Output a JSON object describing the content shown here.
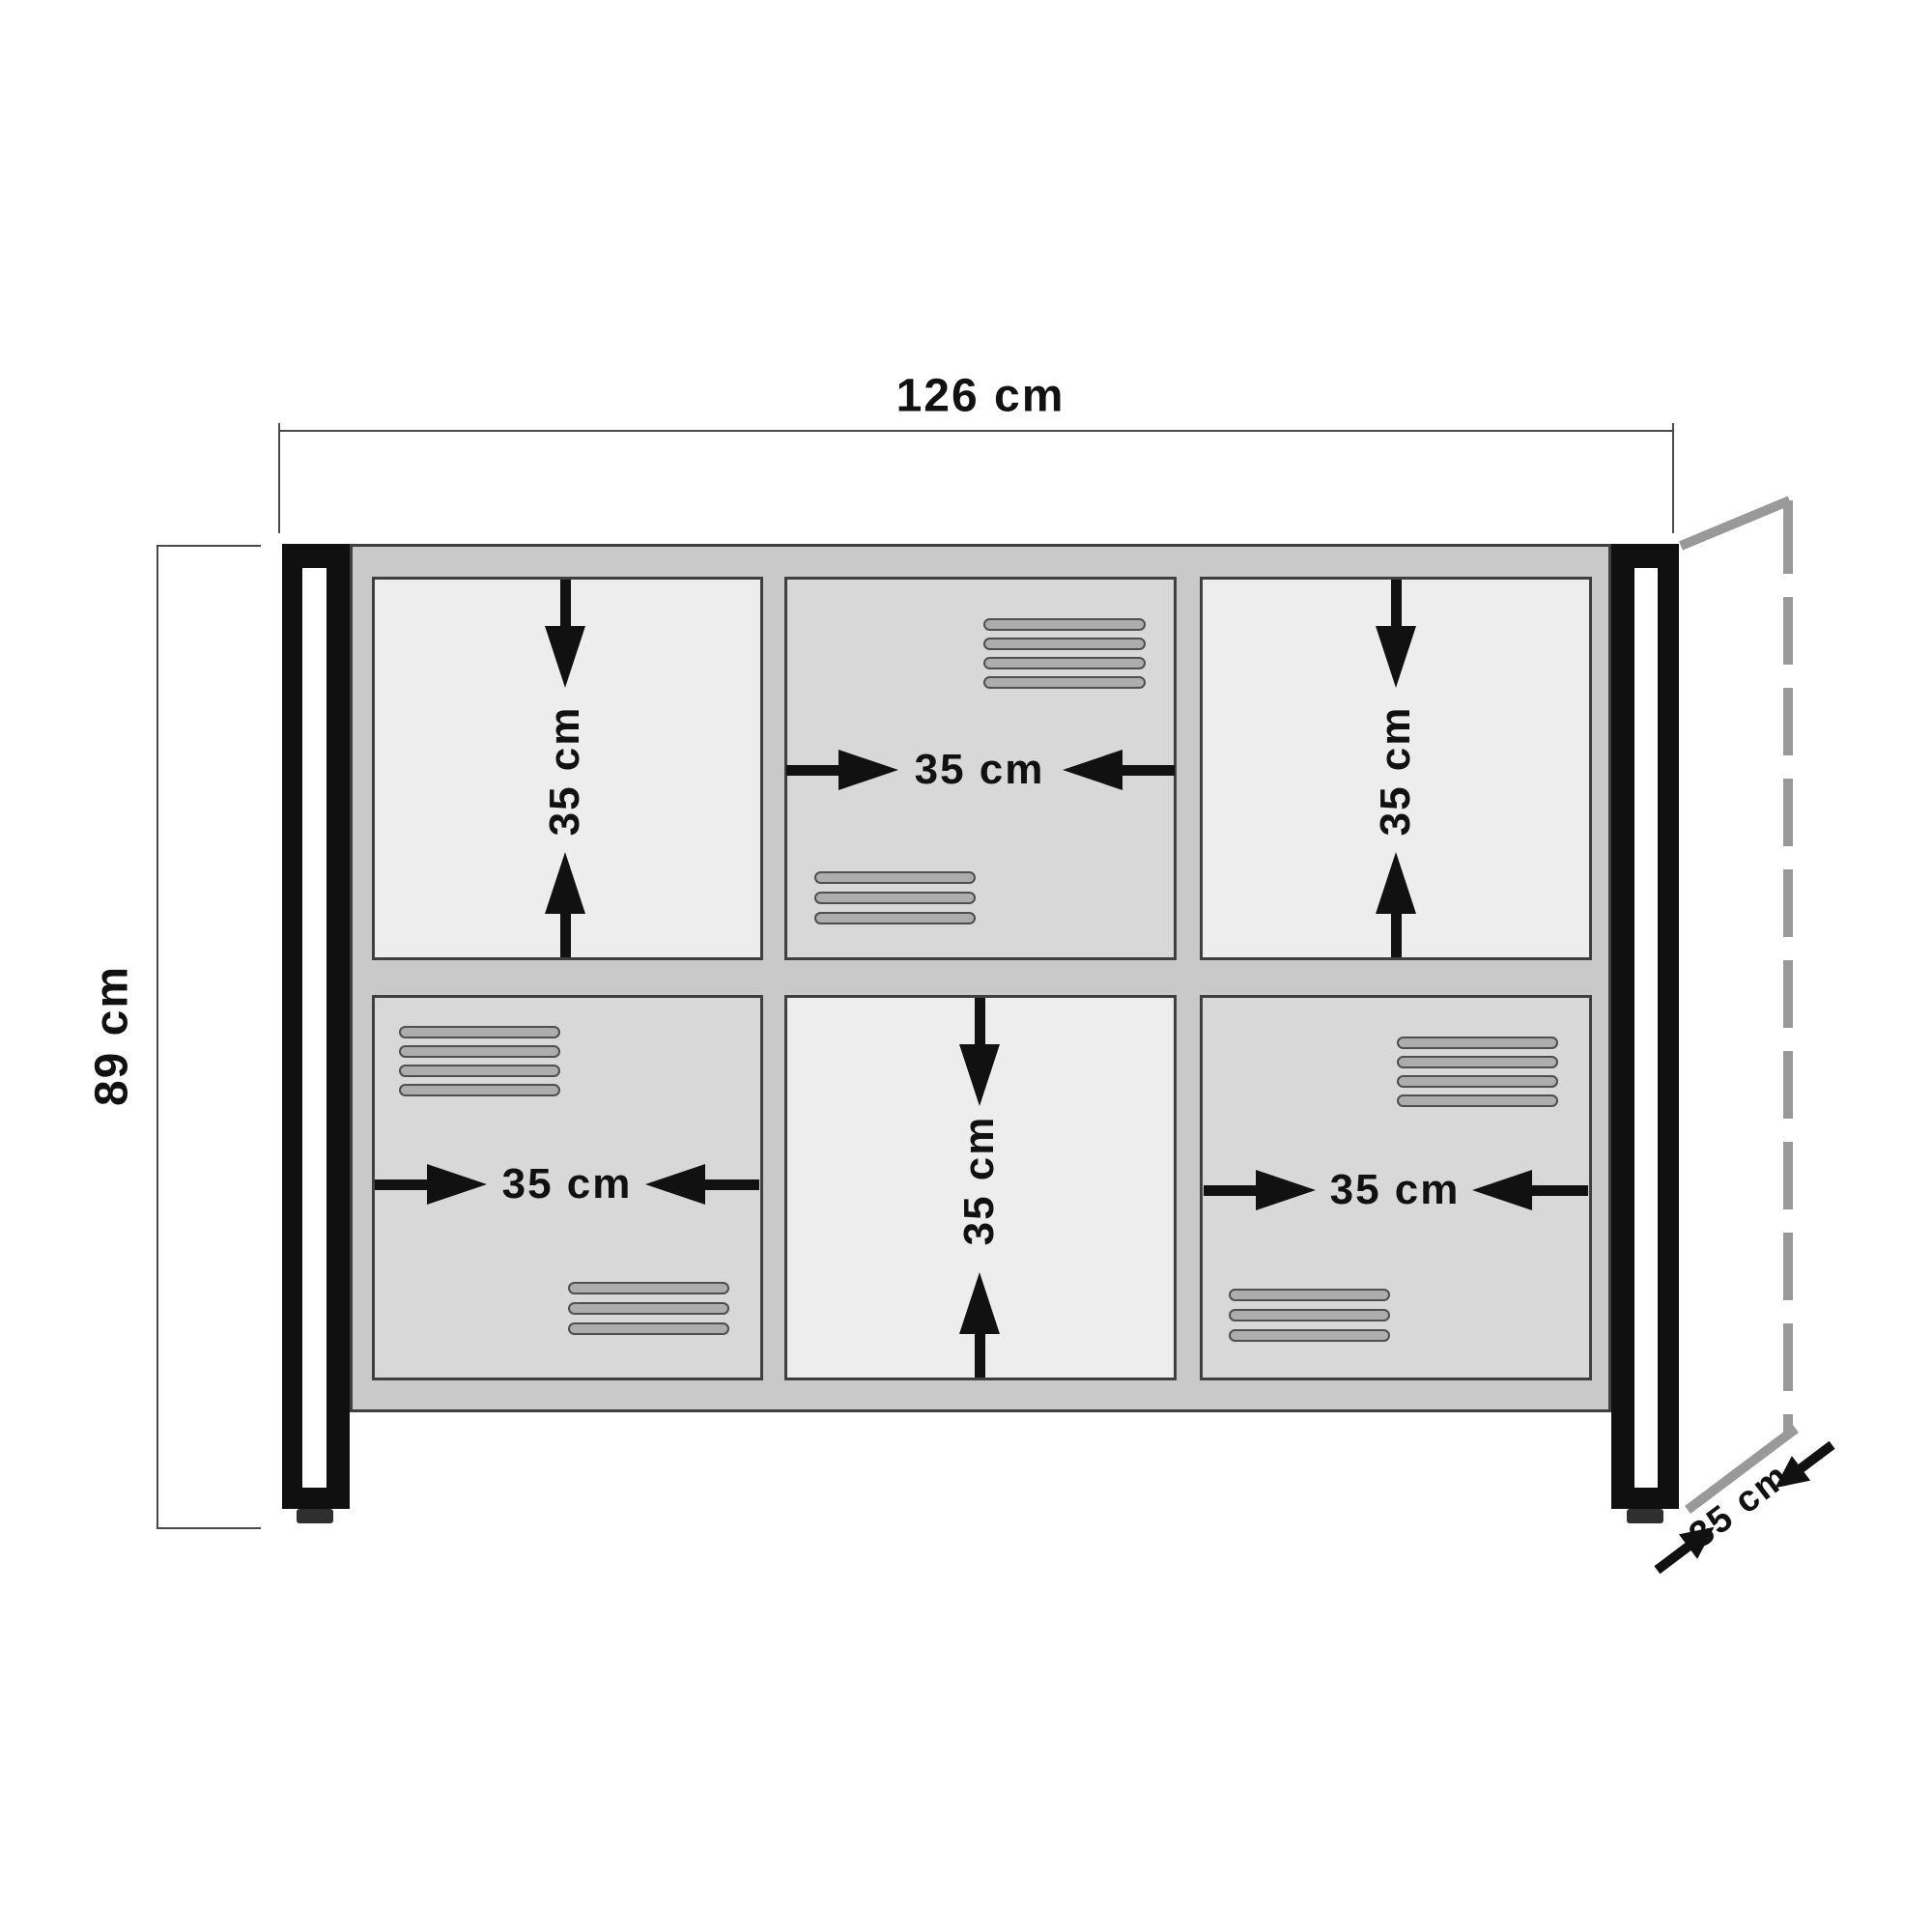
{
  "labels": {
    "width": "126 cm",
    "height": "89 cm",
    "depth": "35 cm",
    "r1c1": "35 cm",
    "r1c2": "35 cm",
    "r1c3": "35 cm",
    "r2c1": "35 cm",
    "r2c2": "35 cm",
    "r2c3": "35 cm"
  },
  "figure": {
    "type": "furniture-dimension-diagram",
    "object": "sideboard cabinet, 2 rows x 3 columns of compartments, 3 vented doors",
    "overall_width_cm": 126,
    "overall_height_cm": 89,
    "overall_depth_cm": 35,
    "compartment_size_cm": 35
  },
  "colors": {
    "background": "#ffffff",
    "frame_gray": "#c9c9c9",
    "open_compartment": "#ededed",
    "door_panel": "#d8d8d8",
    "vent_slat": "#adadad",
    "outline_dark": "#3f3f3f",
    "leg_black": "#101010",
    "dimension_line": "#4a4a4a",
    "depth_line_gray": "#999999",
    "text": "#111111"
  }
}
